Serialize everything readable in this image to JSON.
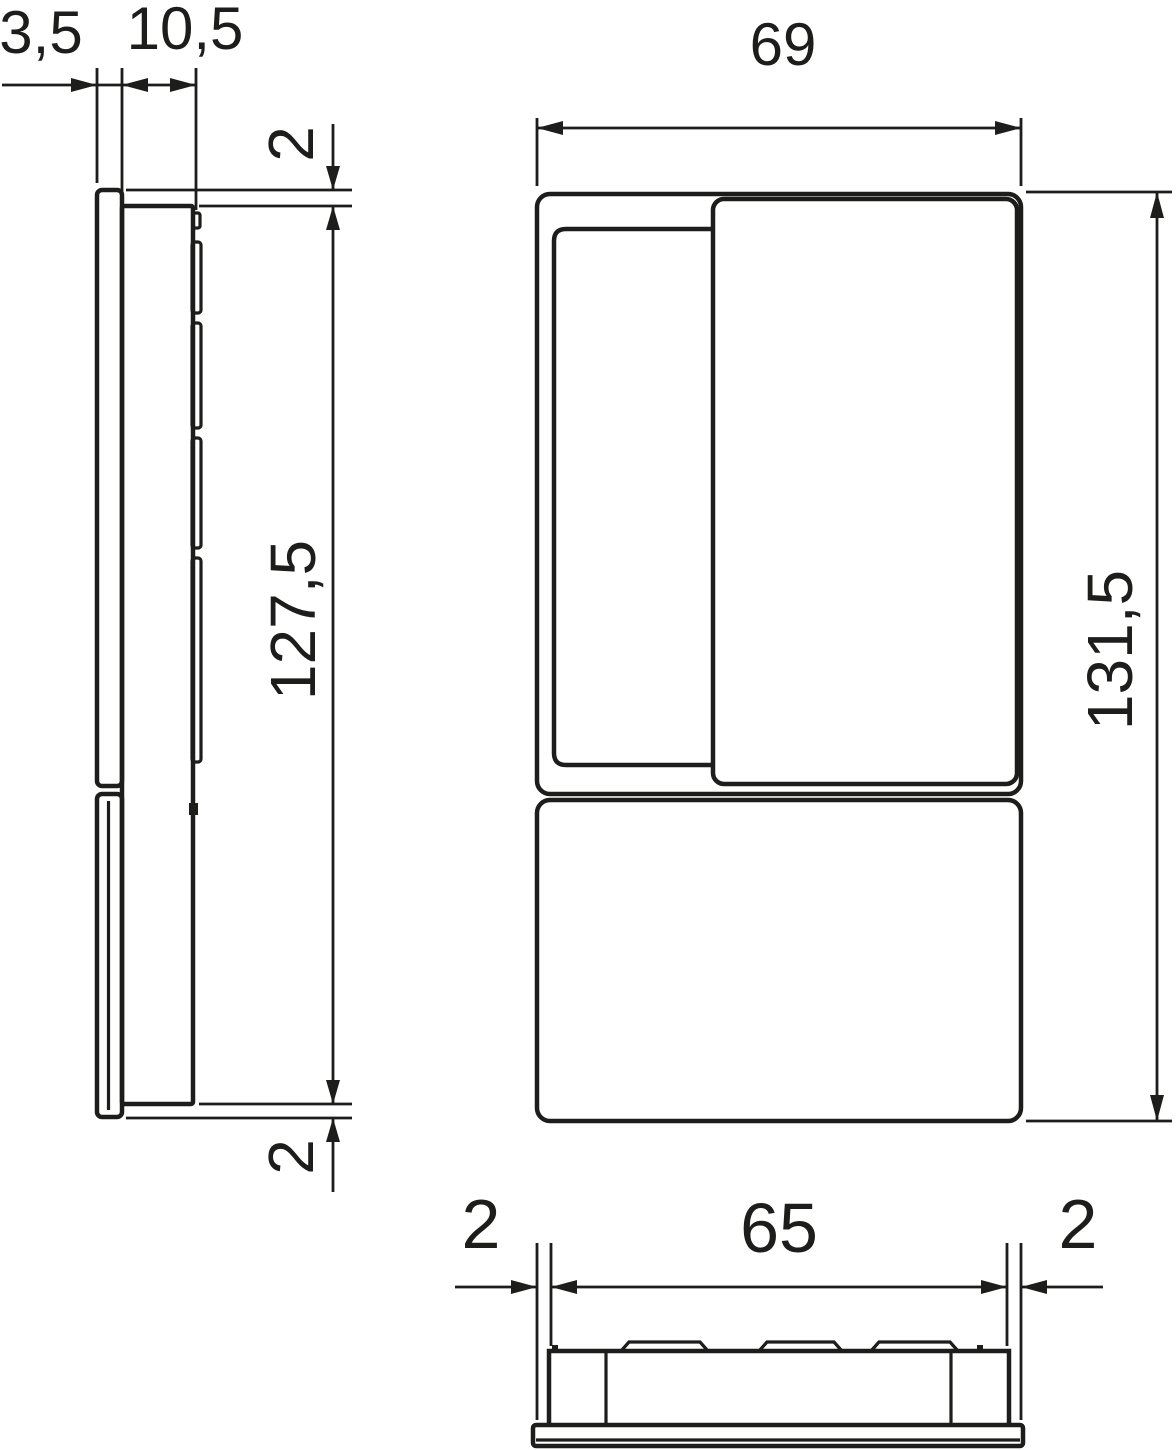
{
  "drawing": {
    "colors": {
      "line": "#1d1d1b",
      "background": "#ffffff"
    },
    "dimensions": {
      "plate_thickness": "3,5",
      "body_depth": "10,5",
      "front_width": "69",
      "top_inset": "2",
      "body_height": "127,5",
      "overall_height": "131,5",
      "bottom_inset": "2",
      "bottom_left_margin": "2",
      "bottom_body_width": "65",
      "bottom_right_margin": "2"
    }
  }
}
